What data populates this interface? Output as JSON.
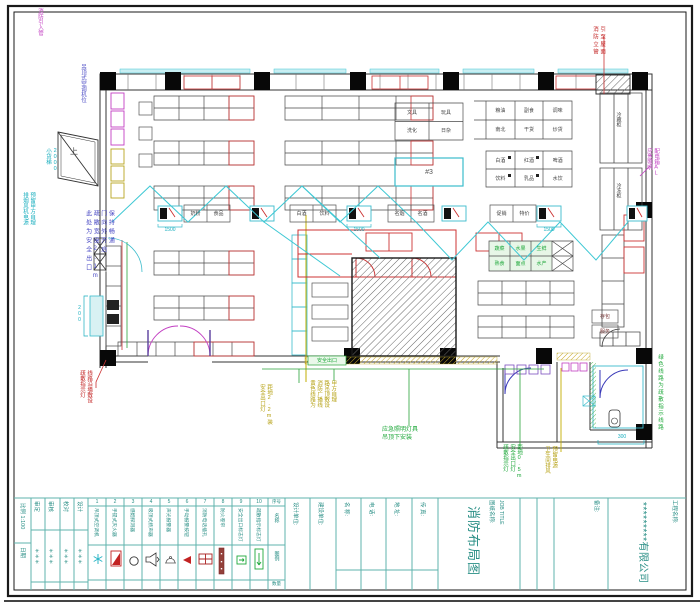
{
  "titleblock": {
    "company": "*********有限公司",
    "project_name_label": "工程名称:",
    "drawing_name_label": "图纸名称:",
    "drawing_name_en": "JOB TITLE",
    "drawing_title": "消防布局图",
    "remarks_label": "备注:",
    "scale_label": "比例 1:100",
    "date_label": "日期",
    "sign_columns": [
      {
        "header": "审定",
        "value": "＊＊＊"
      },
      {
        "header": "审核",
        "value": "＊＊＊"
      },
      {
        "header": "校对",
        "value": "＊＊＊"
      },
      {
        "header": "设计",
        "value": "＊＊＊"
      }
    ],
    "legend_row_headers": [
      "序号",
      "名称",
      "图例",
      "数量"
    ],
    "field_labels": [
      "设计单位:",
      "建设单位:",
      "名 称:",
      "电 话:",
      "地 址:",
      "传 真:"
    ]
  },
  "legend": {
    "items": [
      {
        "no": "1",
        "name": "吊顶式空调机"
      },
      {
        "no": "2",
        "name": "手提式灭火器"
      },
      {
        "no": "3",
        "name": "感烟探测器"
      },
      {
        "no": "4",
        "name": "吸顶式扬声器"
      },
      {
        "no": "5",
        "name": "声光报警器"
      },
      {
        "no": "6",
        "name": "手动报警按钮"
      },
      {
        "no": "7",
        "name": "消防电话插孔"
      },
      {
        "no": "8",
        "name": "防火卷帘"
      },
      {
        "no": "9",
        "name": "安全出口标志灯"
      },
      {
        "no": "10",
        "name": "疏散指示标志灯"
      }
    ]
  },
  "annotations": {
    "top_left": "消防引入管",
    "ceiling_ac": "吊顶式空调机位",
    "freight_lift": [
      "小货梯",
      "2000"
    ],
    "left_cyan": [
      "排烟风机电源",
      "预留甲方自理"
    ],
    "exit_note": [
      "此处为安全出口",
      "疏散宽度2.1m",
      "门向外开启",
      "保持畅通"
    ],
    "left_red": [
      "疏散指示灯",
      "线路沿墙敷设"
    ],
    "riser_red": [
      "消防立管",
      "引至屋面"
    ],
    "right_magenta": [
      "应急照明",
      "配电箱AL"
    ],
    "right_green": "绿色线路为疏散指示线路",
    "yellow_a": [
      "安全出口灯",
      "距地2.2m装"
    ],
    "yellow_b": [
      "黄色线路为",
      "消防广播线",
      "路吊顶敷设",
      "甲方自理"
    ],
    "green_c": [
      "应急照明灯具",
      "吊顶下安装"
    ],
    "green_d": [
      "疏散指示灯",
      "安全出口灯",
      "距地0.5m"
    ],
    "yellow_e": [
      "卫生间排风",
      "预留电源"
    ],
    "exit_strip": "安全出口",
    "ramp": "上"
  },
  "dims": {
    "aisle": "1500",
    "annex": "300",
    "cashier": "200"
  },
  "plan_labels": {
    "freezer_1": "冷藏柜",
    "freezer_2": "冷冻柜",
    "box_1": "存包",
    "box_2": "服务",
    "cyan_area": "#3",
    "table_a": [
      "文具",
      "玩具",
      "洗化",
      "日杂"
    ],
    "table_b": [
      "粮油",
      "副食",
      "调味",
      "南北",
      "干货",
      "炒货"
    ],
    "table_c": [
      "白酒",
      "红酒",
      "啤酒",
      "饮料",
      "乳品",
      "水饮"
    ],
    "table_green": [
      "蔬菜",
      "水果",
      "生鲜",
      "熟食",
      "面点",
      "水产"
    ],
    "aisle_pairs": [
      "奶粉",
      "食品",
      "白酒",
      "饮料",
      "名烟",
      "名酒",
      "促销",
      "特价"
    ]
  }
}
